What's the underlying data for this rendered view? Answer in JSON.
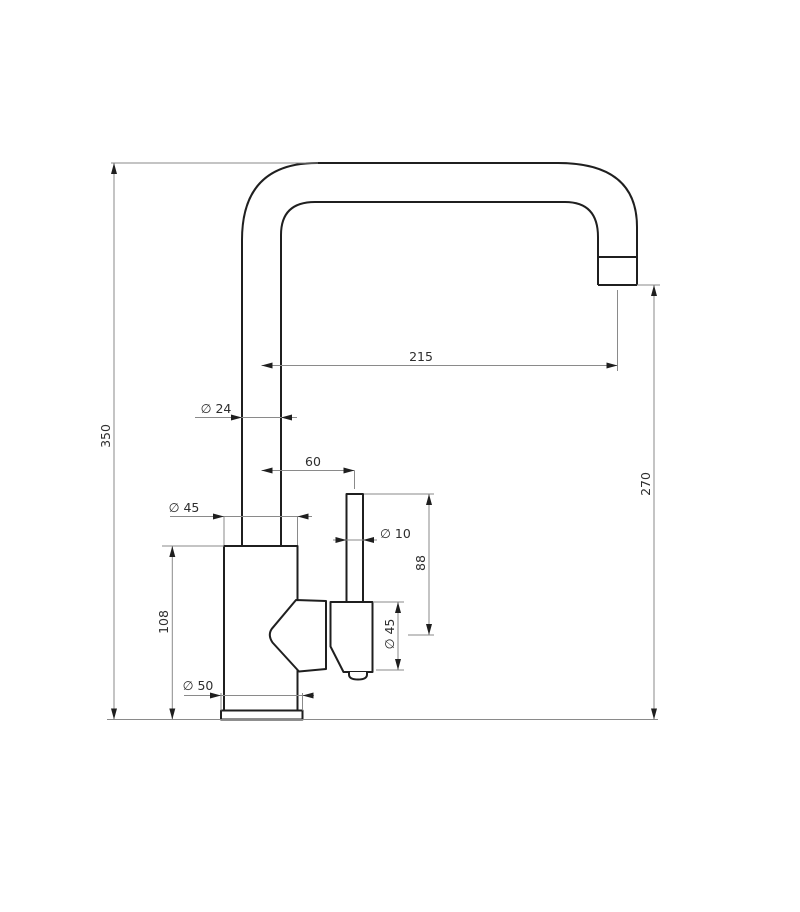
{
  "page": {
    "background": "#ffffff",
    "object_line_color": "#1f1f1f",
    "dimension_line_color": "#8a8a8a",
    "text_color": "#2e2e2e"
  },
  "drawing": {
    "type": "technical-dimension-drawing",
    "dimensions": {
      "spout_reach": "215",
      "spout_tube_diameter": "∅ 24",
      "handle_offset": "60",
      "body_diameter": "∅ 45",
      "handle_stem_diameter": "∅ 10",
      "handle_assembly_height": "88",
      "handle_cartridge_diameter": "∅ 45",
      "body_height": "108",
      "base_diameter": "∅ 50",
      "overall_height": "350",
      "spout_outlet_height": "270"
    }
  }
}
